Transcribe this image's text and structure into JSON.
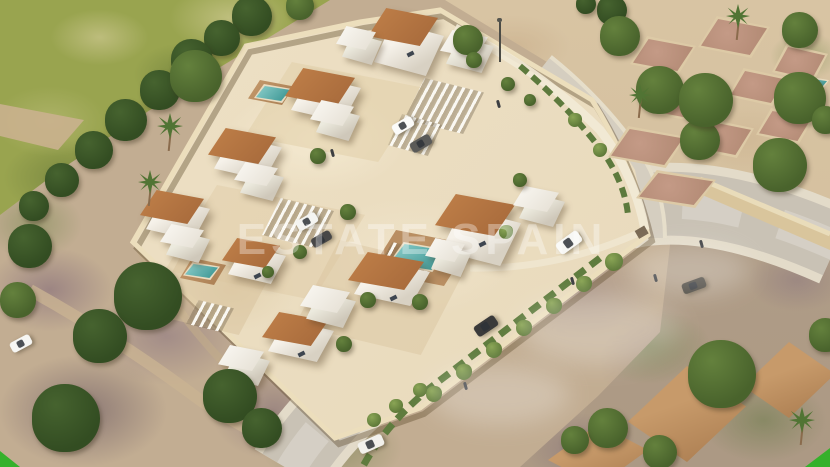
{
  "image": {
    "kind": "aerial-3d-architectural-render",
    "subject": "gated villa development with pools beside roads, vacant ruin lot and existing houses",
    "width": 830,
    "height": 467
  },
  "watermark": {
    "text": "ESTATE SPAIN"
  },
  "branding": {
    "corner_mark_color": "#35b12b"
  },
  "palette": {
    "hill_green": "#99a44f",
    "scrub_tan": "#c2ad92",
    "scrub_mauve": "#836c7d",
    "sand": "#d8c4a3",
    "compound_ground": "#ecdfc3",
    "wall_cream": "#ecdebc",
    "villa_white": "#f4f0e8",
    "roof_terracotta": "#b0703e",
    "pool_teal": "#3fa0a0",
    "road_gray": "#c9c2b5",
    "sidewalk": "#e3dbc9",
    "hedge_green": "#5d7a3d",
    "tree_dark": "#46632f",
    "neighborhood_roof": "#bc8c5e",
    "deck_wood": "#b98e62"
  },
  "scene": {
    "terraces_xywh_color_op": [
      [
        245,
        62,
        180,
        100,
        "#e2cfa9",
        0.55
      ],
      [
        165,
        185,
        200,
        115,
        "#e0cca7",
        0.5
      ],
      [
        295,
        240,
        170,
        115,
        "#d9c39e",
        0.45
      ],
      [
        150,
        255,
        120,
        80,
        "#d7c19c",
        0.5
      ],
      [
        370,
        230,
        100,
        56,
        "#b98e62",
        1
      ]
    ],
    "pond_xywh": [
      76,
      324,
      30,
      17
    ],
    "wood_decks_xywh": [
      [
        180,
        258,
        46,
        27
      ],
      [
        248,
        80,
        46,
        25
      ],
      [
        224,
        138,
        44,
        23
      ],
      [
        280,
        314,
        38,
        21
      ],
      [
        404,
        238,
        58,
        32
      ]
    ],
    "ruin_plots_xywh": [
      [
        630,
        36,
        66,
        38
      ],
      [
        698,
        16,
        72,
        42
      ],
      [
        772,
        44,
        56,
        38
      ],
      [
        652,
        82,
        72,
        42
      ],
      [
        728,
        68,
        60,
        38
      ],
      [
        608,
        126,
        78,
        42
      ],
      [
        688,
        118,
        66,
        40
      ],
      [
        756,
        108,
        58,
        36
      ],
      [
        636,
        170,
        80,
        38
      ]
    ],
    "neighborhood_roofs_xywh": [
      [
        628,
        366,
        118,
        96
      ],
      [
        743,
        342,
        92,
        76
      ],
      [
        548,
        424,
        100,
        62
      ]
    ],
    "pools_xywh": [
      [
        254,
        84,
        38,
        19
      ],
      [
        230,
        142,
        35,
        18
      ],
      [
        183,
        262,
        37,
        18
      ],
      [
        284,
        318,
        30,
        15
      ],
      [
        388,
        242,
        60,
        30
      ],
      [
        806,
        77,
        23,
        12
      ]
    ],
    "pergolas_xywh": [
      [
        404,
        78,
        80,
        56
      ],
      [
        262,
        198,
        72,
        50
      ],
      [
        376,
        242,
        62,
        40
      ],
      [
        388,
        114,
        54,
        42
      ],
      [
        186,
        300,
        48,
        32
      ]
    ],
    "villas_xywh_tall": [
      [
        368,
        8,
        70,
        38,
        1
      ],
      [
        285,
        68,
        70,
        38,
        0
      ],
      [
        208,
        128,
        68,
        36,
        0
      ],
      [
        140,
        190,
        64,
        34,
        0
      ],
      [
        435,
        194,
        80,
        42,
        1
      ],
      [
        348,
        252,
        76,
        38,
        0
      ],
      [
        262,
        312,
        66,
        34,
        0
      ],
      [
        222,
        238,
        58,
        30,
        0
      ]
    ],
    "annex_cubes_xywh": [
      [
        336,
        26,
        40,
        24
      ],
      [
        310,
        100,
        44,
        26
      ],
      [
        234,
        162,
        44,
        24
      ],
      [
        160,
        224,
        44,
        24
      ],
      [
        513,
        186,
        46,
        26
      ],
      [
        300,
        285,
        50,
        28
      ],
      [
        218,
        345,
        46,
        26
      ],
      [
        425,
        238,
        40,
        24
      ],
      [
        440,
        30,
        48,
        28
      ]
    ],
    "trees_xyr_tone": [
      [
        252,
        16,
        20,
        "d"
      ],
      [
        222,
        38,
        18,
        "d"
      ],
      [
        192,
        60,
        21,
        "d"
      ],
      [
        160,
        90,
        20,
        "d"
      ],
      [
        126,
        120,
        21,
        "d"
      ],
      [
        94,
        150,
        19,
        "d"
      ],
      [
        62,
        180,
        17,
        "d"
      ],
      [
        34,
        206,
        15,
        "d"
      ],
      [
        196,
        76,
        26,
        "m"
      ],
      [
        30,
        246,
        22,
        "d"
      ],
      [
        148,
        296,
        34,
        "d"
      ],
      [
        100,
        336,
        27,
        "d"
      ],
      [
        66,
        418,
        34,
        "d"
      ],
      [
        230,
        396,
        27,
        "d"
      ],
      [
        262,
        428,
        20,
        "d"
      ],
      [
        18,
        300,
        18,
        "m"
      ],
      [
        300,
        6,
        14,
        "m"
      ],
      [
        468,
        40,
        15,
        "m"
      ],
      [
        612,
        10,
        15,
        "d"
      ],
      [
        586,
        4,
        10,
        "d"
      ],
      [
        620,
        36,
        20,
        "m"
      ],
      [
        660,
        90,
        24,
        "m"
      ],
      [
        700,
        140,
        20,
        "m"
      ],
      [
        706,
        100,
        27,
        "m"
      ],
      [
        800,
        98,
        26,
        "m"
      ],
      [
        780,
        165,
        27,
        "m"
      ],
      [
        800,
        30,
        18,
        "m"
      ],
      [
        826,
        120,
        14,
        "m"
      ],
      [
        722,
        374,
        34,
        "m"
      ],
      [
        608,
        428,
        20,
        "m"
      ],
      [
        660,
        452,
        17,
        "m"
      ],
      [
        826,
        335,
        17,
        "m"
      ],
      [
        575,
        440,
        14,
        "m"
      ],
      [
        318,
        156,
        8,
        "m"
      ],
      [
        348,
        212,
        8,
        "m"
      ],
      [
        300,
        252,
        7,
        "m"
      ],
      [
        368,
        300,
        8,
        "m"
      ],
      [
        420,
        302,
        8,
        "m"
      ],
      [
        344,
        344,
        8,
        "m"
      ],
      [
        268,
        272,
        6,
        "m"
      ],
      [
        520,
        180,
        7,
        "m"
      ],
      [
        474,
        60,
        8,
        "m"
      ],
      [
        508,
        84,
        7,
        "m"
      ],
      [
        530,
        100,
        6,
        "m"
      ]
    ],
    "vines_xyr": [
      [
        614,
        262,
        9
      ],
      [
        584,
        284,
        8
      ],
      [
        554,
        306,
        8
      ],
      [
        524,
        328,
        8
      ],
      [
        494,
        350,
        8
      ],
      [
        464,
        372,
        8
      ],
      [
        434,
        394,
        8
      ],
      [
        506,
        232,
        7
      ],
      [
        600,
        150,
        7
      ],
      [
        575,
        120,
        7
      ],
      [
        420,
        390,
        7
      ],
      [
        396,
        406,
        7
      ],
      [
        374,
        420,
        7
      ]
    ],
    "palms_xyr": [
      [
        170,
        126,
        13
      ],
      [
        150,
        182,
        12
      ],
      [
        738,
        16,
        12
      ],
      [
        802,
        420,
        13
      ],
      [
        640,
        95,
        11
      ]
    ],
    "cars": [
      {
        "x": 556,
        "y": 236,
        "angle": -36,
        "color": "#f7f7f4",
        "w": 26,
        "h": 13,
        "label": "white-suv-on-road"
      },
      {
        "x": 474,
        "y": 320,
        "angle": -34,
        "color": "#3a3a3a",
        "w": 24,
        "h": 12,
        "label": "dark-sedan-on-road"
      },
      {
        "x": 682,
        "y": 280,
        "angle": -20,
        "color": "#4a463e",
        "w": 24,
        "h": 11,
        "label": "dark-car-lower-road"
      },
      {
        "x": 358,
        "y": 438,
        "angle": -24,
        "color": "#f2f1ec",
        "w": 26,
        "h": 12,
        "label": "white-pickup"
      },
      {
        "x": 392,
        "y": 120,
        "angle": -30,
        "color": "#fbfbf9",
        "w": 22,
        "h": 11,
        "label": "parked-white-car"
      },
      {
        "x": 410,
        "y": 138,
        "angle": -30,
        "color": "#5a5a58",
        "w": 22,
        "h": 11,
        "label": "parked-gray-car"
      },
      {
        "x": 296,
        "y": 216,
        "angle": -30,
        "color": "#f4f4f1",
        "w": 22,
        "h": 11,
        "label": "parked-white-car"
      },
      {
        "x": 311,
        "y": 234,
        "angle": -30,
        "color": "#474747",
        "w": 21,
        "h": 10,
        "label": "parked-dark-car"
      },
      {
        "x": 10,
        "y": 338,
        "angle": -28,
        "color": "#f6f6f3",
        "w": 22,
        "h": 11,
        "label": "parked-white-car"
      }
    ],
    "people_xy": [
      [
        571,
        277
      ],
      [
        654,
        274
      ],
      [
        700,
        240
      ],
      [
        464,
        382
      ],
      [
        497,
        100
      ],
      [
        331,
        149
      ]
    ],
    "lamppost_xy": [
      497,
      18
    ],
    "haze_xywh": [
      [
        600,
        330,
        160,
        70
      ],
      [
        500,
        395,
        140,
        60
      ],
      [
        690,
        270,
        120,
        50
      ]
    ]
  }
}
